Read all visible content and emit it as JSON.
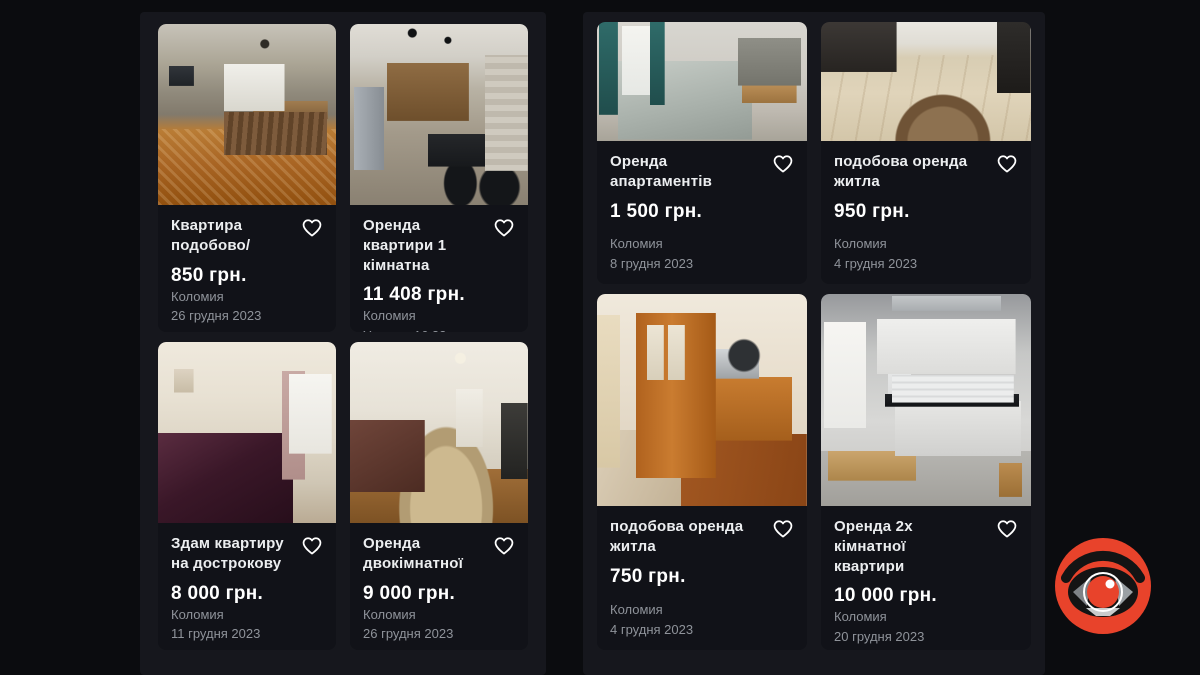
{
  "theme": {
    "page_bg": "#0b0c0f",
    "panel_bg": "#16171d",
    "card_bg": "#111218",
    "text_primary": "#eceef0",
    "text_secondary": "#8f939a",
    "price_color": "#ffffff",
    "logo_red": "#e8432b"
  },
  "icons": {
    "favorite": "heart-outline"
  },
  "logo": {
    "name": "eye-camera-logo"
  },
  "panels": [
    {
      "id": "left-listings",
      "cards": [
        {
          "title": "Квартира подобово/",
          "price": "850 грн.",
          "location": "Коломия",
          "date": "26 грудня 2023",
          "photo": "bedroom-parquet"
        },
        {
          "title": "Оренда квартири 1 кімнатна",
          "price": "11 408 грн.",
          "location": "Коломия",
          "date": "Учора в 16:32",
          "photo": "kitchen-wood"
        },
        {
          "title": "Здам квартиру на дострокову",
          "price": "8 000 грн.",
          "location": "Коломия",
          "date": "11 грудня 2023",
          "photo": "bedroom-burgundy"
        },
        {
          "title": "Оренда двокімнатної",
          "price": "9 000 грн.",
          "location": "Коломия",
          "date": "26 грудня 2023",
          "photo": "living-room-rug"
        }
      ]
    },
    {
      "id": "right-listings",
      "cards": [
        {
          "title": "Оренда апартаментів",
          "price": "1 500 грн.",
          "location": "Коломия",
          "date": "8 грудня 2023",
          "photo": "sofa-gray"
        },
        {
          "title": "подобова оренда житла",
          "price": "950 грн.",
          "location": "Коломия",
          "date": "4 грудня 2023",
          "photo": "wood-floor"
        },
        {
          "title": "подобова оренда житла",
          "price": "750 грн.",
          "location": "Коломия",
          "date": "4 грудня 2023",
          "photo": "wardrobe-room"
        },
        {
          "title": "Оренда 2х кімнатної квартири",
          "price": "10 000 грн.",
          "location": "Коломия",
          "date": "20 грудня 2023",
          "photo": "white-kitchen"
        }
      ]
    }
  ]
}
